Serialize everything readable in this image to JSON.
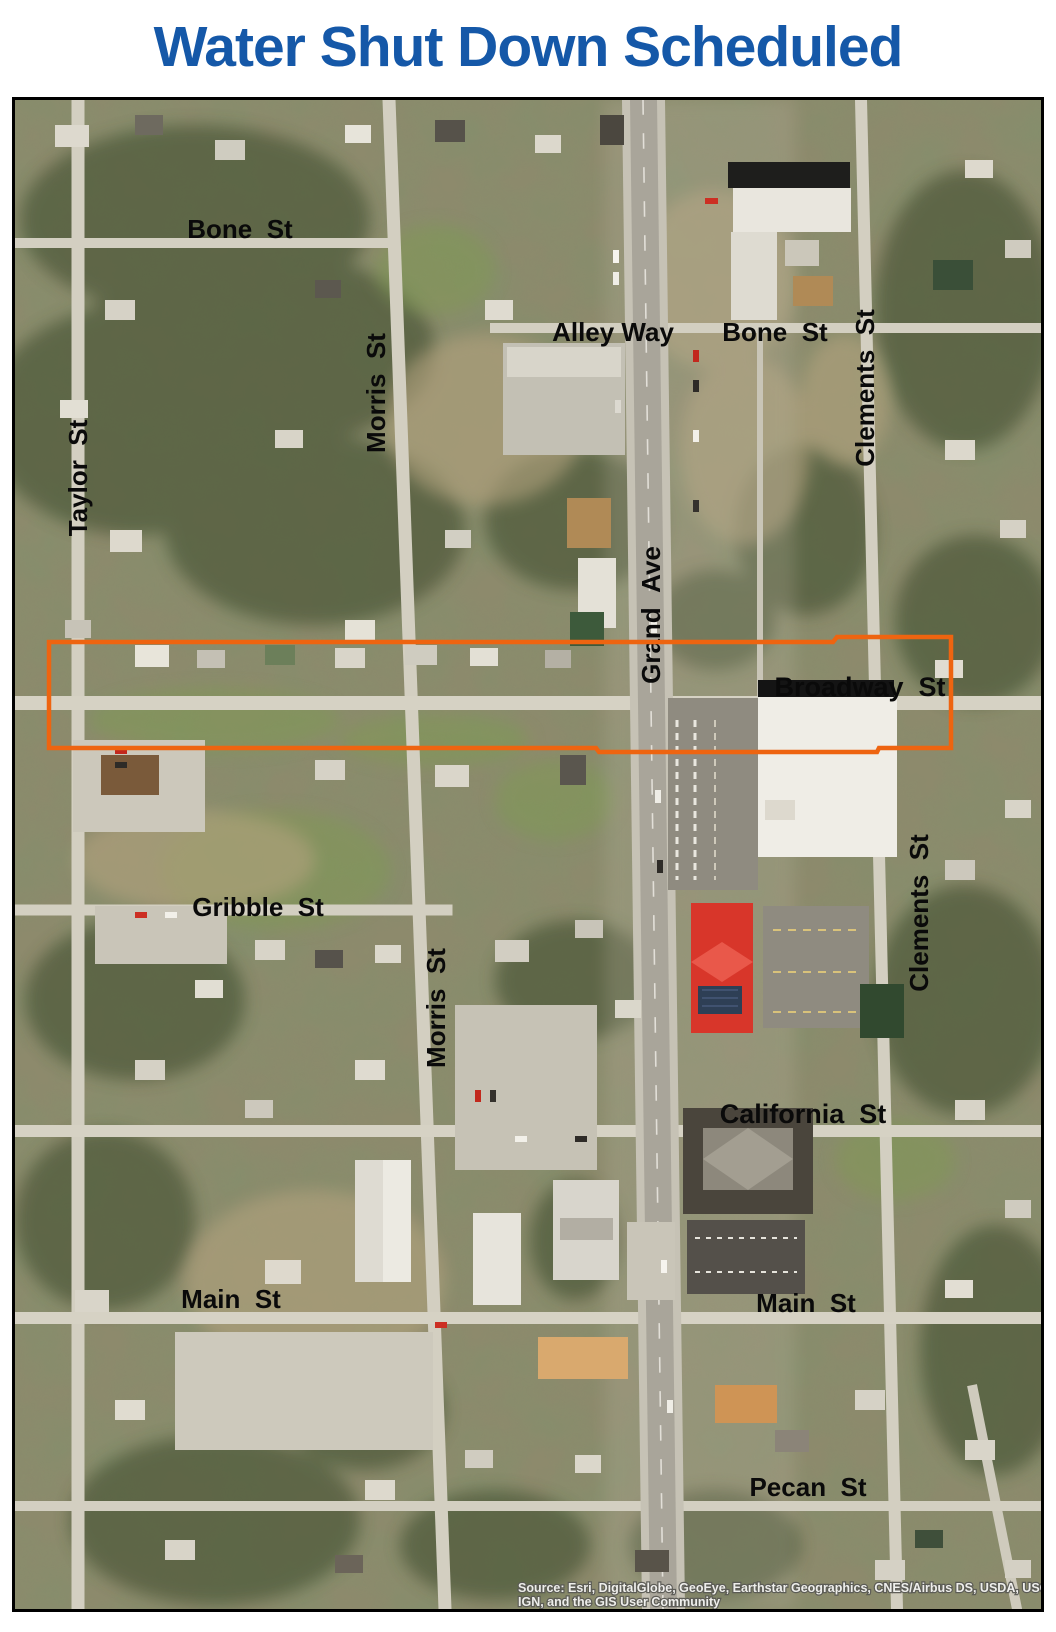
{
  "title": "Water Shut Down Scheduled",
  "colors": {
    "title_blue": "#1558a8",
    "highlight_orange": "#ee6410",
    "label_black": "#0a0a0a"
  },
  "map": {
    "street_labels": [
      {
        "id": "bone-st-left",
        "text": "Bone  St",
        "orientation": "horizontal"
      },
      {
        "id": "alley-way",
        "text": "Alley Way",
        "orientation": "horizontal"
      },
      {
        "id": "bone-st-right",
        "text": "Bone  St",
        "orientation": "horizontal"
      },
      {
        "id": "clements-st-upper",
        "text": "Clements  St",
        "orientation": "vertical"
      },
      {
        "id": "taylor-st",
        "text": "Taylor  St",
        "orientation": "vertical"
      },
      {
        "id": "morris-st-upper",
        "text": "Morris  St",
        "orientation": "vertical"
      },
      {
        "id": "grand-ave",
        "text": "Grand  Ave",
        "orientation": "vertical"
      },
      {
        "id": "broadway-st",
        "text": "Broadway  St",
        "orientation": "horizontal"
      },
      {
        "id": "gribble-st",
        "text": "Gribble  St",
        "orientation": "horizontal"
      },
      {
        "id": "morris-st-lower",
        "text": "Morris  St",
        "orientation": "vertical"
      },
      {
        "id": "clements-st-lower",
        "text": "Clements  St",
        "orientation": "vertical"
      },
      {
        "id": "california-st",
        "text": "California  St",
        "orientation": "horizontal"
      },
      {
        "id": "main-st-left",
        "text": "Main  St",
        "orientation": "horizontal"
      },
      {
        "id": "main-st-right",
        "text": "Main  St",
        "orientation": "horizontal"
      },
      {
        "id": "pecan-st",
        "text": "Pecan  St",
        "orientation": "horizontal"
      }
    ],
    "attribution_line1": "Source: Esri, DigitalGlobe, GeoEye, Earthstar Geographics, CNES/Airbus DS, USDA, USGS, AeroGRID,",
    "attribution_line2": "IGN, and the GIS User Community"
  }
}
